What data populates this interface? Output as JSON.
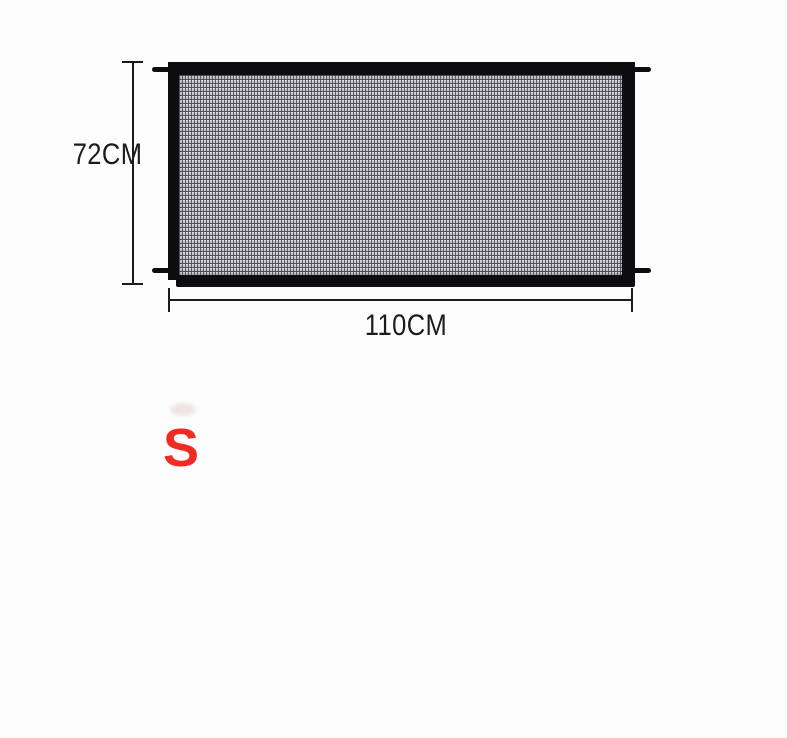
{
  "diagram": {
    "description": "mesh-safety-gate-size-diagram",
    "height_label": "72CM",
    "width_label": "110CM",
    "size_label": "S"
  },
  "colors": {
    "background": "#fdfdfd",
    "frame_black": "#0d0d0f",
    "mesh_base": "#c6c6cb",
    "mesh_grid": "#5a5a62",
    "dimension_ink": "#1c1c1e",
    "size_red": "#ee2c23"
  }
}
